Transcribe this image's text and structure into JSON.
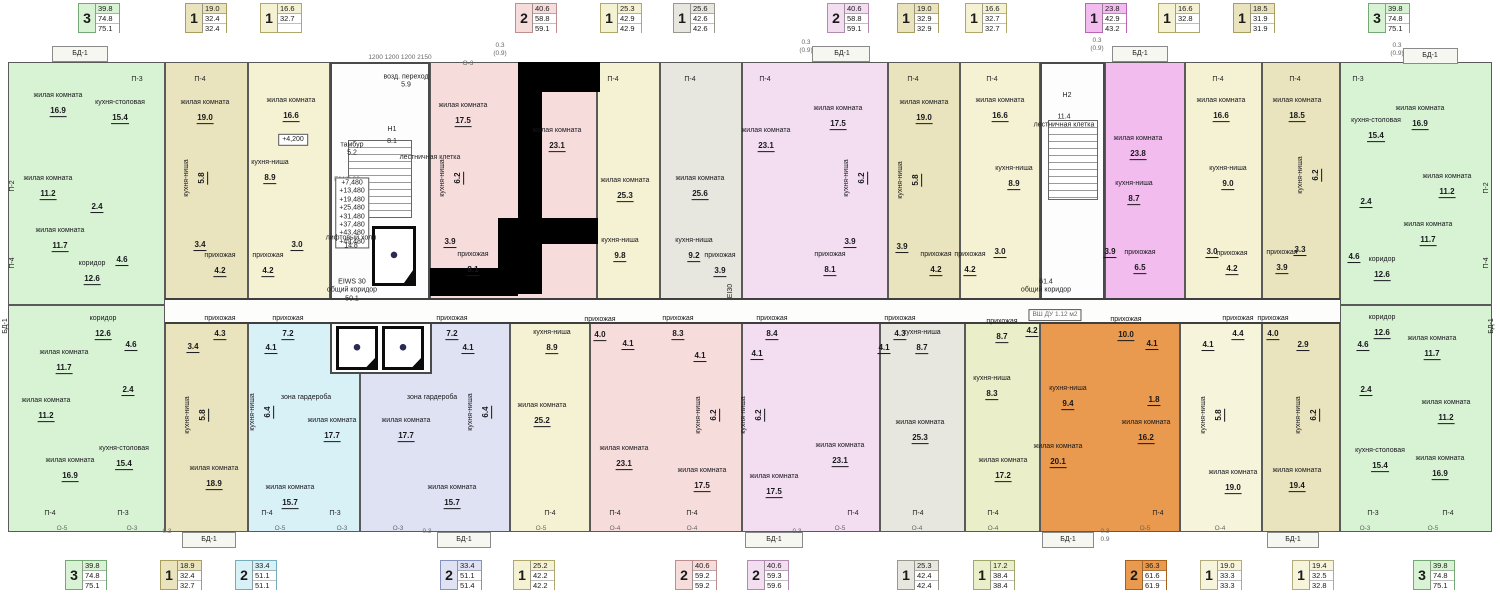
{
  "palette": {
    "green": "#d8f2d4",
    "olive": "#e9e4bd",
    "yellow": "#f5f1d3",
    "pink": "#f7dcdc",
    "gray": "#e7e7e0",
    "violet": "#f3ddf1",
    "magenta": "#f2bcee",
    "cyan": "#d8f1f7",
    "lavender": "#dfe2f3",
    "orange": "#e99a4e",
    "cream": "#f7f4dc",
    "yellowgreen": "#ebefc9",
    "wall": "#3f3f3f"
  },
  "badge_borders": {
    "green": "#74a874",
    "olive": "#a89e5e",
    "yellow": "#b0a86a",
    "pink": "#bf8f8f",
    "gray": "#98988e",
    "violet": "#b28cb0",
    "magenta": "#bf63b7",
    "cyan": "#74aebc",
    "lavender": "#8791bf",
    "orange": "#a95f18",
    "cream": "#b3ab7c",
    "yellowgreen": "#9fa868"
  },
  "top_badges": [
    {
      "c": "green",
      "rooms": "3",
      "vals": [
        "39.8",
        "74.8",
        "75.1"
      ]
    },
    {
      "c": "olive",
      "rooms": "1",
      "vals": [
        "19.0",
        "32.4",
        "32.4"
      ]
    },
    {
      "c": "yellow",
      "rooms": "1",
      "vals": [
        "16.6",
        "32.7",
        ""
      ]
    },
    {
      "c": "pink",
      "rooms": "2",
      "vals": [
        "40.6",
        "58.8",
        "59.1"
      ]
    },
    {
      "c": "yellow",
      "rooms": "1",
      "vals": [
        "25.3",
        "42.9",
        "42.9"
      ]
    },
    {
      "c": "gray",
      "rooms": "1",
      "vals": [
        "25.6",
        "42.6",
        "42.6"
      ]
    },
    {
      "c": "violet",
      "rooms": "2",
      "vals": [
        "40.6",
        "58.8",
        "59.1"
      ]
    },
    {
      "c": "olive",
      "rooms": "1",
      "vals": [
        "19.0",
        "32.9",
        "32.9"
      ]
    },
    {
      "c": "yellow",
      "rooms": "1",
      "vals": [
        "16.6",
        "32.7",
        "32.7"
      ]
    },
    {
      "c": "magenta",
      "rooms": "1",
      "vals": [
        "23.8",
        "42.9",
        "43.2"
      ]
    },
    {
      "c": "yellow",
      "rooms": "1",
      "vals": [
        "16.6",
        "32.8",
        ""
      ]
    },
    {
      "c": "olive",
      "rooms": "1",
      "vals": [
        "18.5",
        "31.9",
        "31.9"
      ]
    },
    {
      "c": "green",
      "rooms": "3",
      "vals": [
        "39.8",
        "74.8",
        "75.1"
      ]
    }
  ],
  "bottom_badges": [
    {
      "c": "green",
      "rooms": "3",
      "vals": [
        "39.8",
        "74.8",
        "75.1"
      ]
    },
    {
      "c": "olive",
      "rooms": "1",
      "vals": [
        "18.9",
        "32.4",
        "32.7"
      ]
    },
    {
      "c": "cyan",
      "rooms": "2",
      "vals": [
        "33.4",
        "51.1",
        "51.1"
      ]
    },
    {
      "c": "lavender",
      "rooms": "2",
      "vals": [
        "33.4",
        "51.1",
        "51.4"
      ]
    },
    {
      "c": "yellow",
      "rooms": "1",
      "vals": [
        "25.2",
        "42.2",
        "42.2"
      ]
    },
    {
      "c": "pink",
      "rooms": "2",
      "vals": [
        "40.6",
        "59.2",
        "59.2"
      ]
    },
    {
      "c": "violet",
      "rooms": "2",
      "vals": [
        "40.6",
        "59.3",
        "59.6"
      ]
    },
    {
      "c": "gray",
      "rooms": "1",
      "vals": [
        "25.3",
        "42.4",
        "42.4"
      ]
    },
    {
      "c": "yellowgreen",
      "rooms": "1",
      "vals": [
        "17.2",
        "38.4",
        "38.4"
      ]
    },
    {
      "c": "orange",
      "rooms": "2",
      "vals": [
        "36.3",
        "61.6",
        "61.9"
      ]
    },
    {
      "c": "cream",
      "rooms": "1",
      "vals": [
        "19.0",
        "33.3",
        "33.3"
      ]
    },
    {
      "c": "cream",
      "rooms": "1",
      "vals": [
        "19.4",
        "32.5",
        "32.8"
      ]
    },
    {
      "c": "green",
      "rooms": "3",
      "vals": [
        "39.8",
        "74.8",
        "75.1"
      ]
    }
  ],
  "plan": {
    "apartments": [
      {
        "id": "a1",
        "color": "green",
        "rooms": [
          {
            "n": "жилая комната",
            "a": "16.9"
          },
          {
            "n": "кухня-столовая",
            "a": "15.4"
          },
          {
            "n": "жилая комната",
            "a": "11.2"
          },
          {
            "a": "2.4"
          },
          {
            "n": "жилая комната",
            "a": "11.7"
          },
          {
            "a": "4.6"
          },
          {
            "n": "коридор",
            "a": "12.6"
          }
        ]
      },
      {
        "id": "a2",
        "color": "olive",
        "rooms": [
          {
            "n": "жилая комната",
            "a": "19.0"
          },
          {
            "n": "кухня-ниша",
            "a": "5.8",
            "v": 1
          },
          {
            "a": "3.4"
          },
          {
            "n": "прихожая",
            "a": "4.2"
          }
        ]
      },
      {
        "id": "a3",
        "color": "yellow",
        "rooms": [
          {
            "n": "жилая комната",
            "a": "16.6"
          },
          {
            "n": "кухня-ниша",
            "a": "8.9"
          },
          {
            "a": "3.0"
          },
          {
            "n": "прихожая",
            "a": "4.2"
          }
        ]
      },
      {
        "id": "a4",
        "color": "pink",
        "rooms": [
          {
            "n": "жилая комната",
            "a": "17.5"
          },
          {
            "n": "жилая комната",
            "a": "23.1"
          },
          {
            "n": "кухня-ниша",
            "a": "6.2",
            "v": 1
          },
          {
            "a": "3.9"
          },
          {
            "n": "прихожая",
            "a": "8.1"
          }
        ]
      },
      {
        "id": "a5",
        "color": "yellow",
        "rooms": [
          {
            "n": "жилая комната",
            "a": "25.3"
          },
          {
            "n": "кухня-ниша",
            "a": "9.8"
          }
        ]
      },
      {
        "id": "a6",
        "color": "gray",
        "rooms": [
          {
            "n": "жилая комната",
            "a": "25.6"
          },
          {
            "n": "кухня-ниша",
            "a": "9.2"
          },
          {
            "n": "прихожая",
            "a": "3.9"
          }
        ]
      },
      {
        "id": "a7",
        "color": "violet",
        "rooms": [
          {
            "n": "жилая комната",
            "a": "23.1"
          },
          {
            "n": "жилая комната",
            "a": "17.5"
          },
          {
            "n": "кухня-ниша",
            "a": "6.2",
            "v": 1
          },
          {
            "a": "3.9"
          },
          {
            "n": "прихожая",
            "a": "8.1"
          }
        ]
      },
      {
        "id": "a8",
        "color": "olive",
        "rooms": [
          {
            "n": "жилая комната",
            "a": "19.0"
          },
          {
            "n": "кухня-ниша",
            "a": "5.8",
            "v": 1
          },
          {
            "a": "3.9"
          },
          {
            "n": "прихожая",
            "a": "4.2"
          }
        ]
      },
      {
        "id": "a9",
        "color": "yellow",
        "rooms": [
          {
            "n": "жилая комната",
            "a": "16.6"
          },
          {
            "n": "кухня-ниша",
            "a": "8.9"
          },
          {
            "a": "3.0"
          },
          {
            "n": "прихожая",
            "a": "4.2"
          }
        ]
      },
      {
        "id": "a10",
        "color": "magenta",
        "rooms": [
          {
            "n": "жилая комната",
            "a": "23.8"
          },
          {
            "n": "кухня-ниша",
            "a": "8.7"
          },
          {
            "a": "3.9"
          },
          {
            "n": "прихожая",
            "a": "6.5"
          }
        ]
      },
      {
        "id": "a11",
        "color": "yellow",
        "rooms": [
          {
            "n": "жилая комната",
            "a": "16.6"
          },
          {
            "n": "кухня-ниша",
            "a": "9.0"
          },
          {
            "a": "3.0"
          },
          {
            "n": "прихожая",
            "a": "4.2"
          }
        ]
      },
      {
        "id": "a12",
        "color": "olive",
        "rooms": [
          {
            "n": "жилая комната",
            "a": "18.5"
          },
          {
            "n": "кухня-ниша",
            "a": "6.2",
            "v": 1
          },
          {
            "a": "3.3"
          },
          {
            "n": "прихожая",
            "a": "3.9"
          }
        ]
      },
      {
        "id": "a13",
        "color": "green",
        "rooms": [
          {
            "n": "кухня-столовая",
            "a": "15.4"
          },
          {
            "n": "жилая комната",
            "a": "16.9"
          },
          {
            "n": "жилая комната",
            "a": "11.2"
          },
          {
            "a": "2.4"
          },
          {
            "n": "жилая комната",
            "a": "11.7"
          },
          {
            "a": "4.6"
          },
          {
            "n": "коридор",
            "a": "12.6"
          }
        ]
      },
      {
        "id": "b1",
        "color": "green",
        "rooms": [
          {
            "n": "коридор",
            "a": "12.6"
          },
          {
            "a": "4.6"
          },
          {
            "n": "жилая комната",
            "a": "11.7"
          },
          {
            "a": "2.4"
          },
          {
            "n": "жилая комната",
            "a": "11.2"
          },
          {
            "n": "жилая комната",
            "a": "16.9"
          },
          {
            "n": "кухня-столовая",
            "a": "15.4"
          }
        ]
      },
      {
        "id": "b2",
        "color": "olive",
        "rooms": [
          {
            "n": "прихожая",
            "a": "4.3"
          },
          {
            "a": "3.4"
          },
          {
            "n": "кухня-ниша",
            "a": "5.8",
            "v": 1
          },
          {
            "n": "жилая комната",
            "a": "18.9"
          }
        ]
      },
      {
        "id": "b3",
        "color": "cyan",
        "rooms": [
          {
            "n": "прихожая",
            "a": "7.2"
          },
          {
            "a": "4.1"
          },
          {
            "n": "кухня-ниша",
            "a": "6.4",
            "v": 1
          },
          {
            "n": "зона гардероба"
          },
          {
            "n": "жилая комната",
            "a": "17.7"
          },
          {
            "n": "жилая комната",
            "a": "15.7"
          }
        ]
      },
      {
        "id": "b4",
        "color": "lavender",
        "rooms": [
          {
            "n": "прихожая",
            "a": "7.2"
          },
          {
            "a": "4.1"
          },
          {
            "n": "кухня-ниша",
            "a": "6.4",
            "v": 1
          },
          {
            "n": "зона гардероба"
          },
          {
            "n": "жилая комната",
            "a": "17.7"
          },
          {
            "n": "жилая комната",
            "a": "15.7"
          }
        ]
      },
      {
        "id": "b5",
        "color": "yellow",
        "rooms": [
          {
            "n": "кухня-ниша",
            "a": "8.9"
          },
          {
            "n": "прихожая",
            "a": "4.0"
          },
          {
            "a": "4.1"
          },
          {
            "n": "жилая комната",
            "a": "25.2"
          }
        ]
      },
      {
        "id": "b6",
        "color": "pink",
        "rooms": [
          {
            "n": "прихожая",
            "a": "8.3"
          },
          {
            "a": "4.1"
          },
          {
            "n": "кухня-ниша",
            "a": "6.2",
            "v": 1
          },
          {
            "n": "жилая комната",
            "a": "23.1"
          },
          {
            "n": "жилая комната",
            "a": "17.5"
          }
        ]
      },
      {
        "id": "b7",
        "color": "violet",
        "rooms": [
          {
            "n": "прихожая",
            "a": "8.4"
          },
          {
            "a": "4.1"
          },
          {
            "n": "кухня-ниша",
            "a": "6.2",
            "v": 1
          },
          {
            "n": "жилая комната",
            "a": "23.1"
          },
          {
            "n": "жилая комната",
            "a": "17.5"
          }
        ]
      },
      {
        "id": "b8",
        "color": "gray",
        "rooms": [
          {
            "n": "прихожая",
            "a": "4.3"
          },
          {
            "a": "4.1"
          },
          {
            "n": "кухня-ниша",
            "a": "8.7"
          },
          {
            "n": "жилая комната",
            "a": "25.3"
          }
        ]
      },
      {
        "id": "b9",
        "color": "yellowgreen",
        "rooms": [
          {
            "n": "прихожая",
            "a": "8.7"
          },
          {
            "a": "4.2"
          },
          {
            "n": "кухня-ниша",
            "a": "8.3"
          },
          {
            "n": "жилая комната",
            "a": "17.2"
          }
        ]
      },
      {
        "id": "b10",
        "color": "orange",
        "rooms": [
          {
            "n": "прихожая",
            "a": "10.0"
          },
          {
            "a": "4.1"
          },
          {
            "n": "кухня-ниша",
            "a": "9.4"
          },
          {
            "a": "1.8"
          },
          {
            "n": "жилая комната",
            "a": "20.1"
          },
          {
            "n": "жилая комната",
            "a": "16.2"
          }
        ]
      },
      {
        "id": "b11",
        "color": "cream",
        "rooms": [
          {
            "n": "прихожая",
            "a": "4.4"
          },
          {
            "a": "4.1"
          },
          {
            "n": "кухня-ниша",
            "a": "5.8",
            "v": 1
          },
          {
            "n": "жилая комната",
            "a": "19.0"
          }
        ]
      },
      {
        "id": "b12",
        "color": "olive",
        "rooms": [
          {
            "n": "прихожая",
            "a": "4.0"
          },
          {
            "a": "2.9"
          },
          {
            "n": "кухня-ниша",
            "a": "6.2",
            "v": 1
          },
          {
            "n": "жилая комната",
            "a": "19.4"
          }
        ]
      },
      {
        "id": "b13",
        "color": "green",
        "rooms": [
          {
            "n": "коридор",
            "a": "12.6"
          },
          {
            "a": "4.6"
          },
          {
            "n": "жилая комната",
            "a": "11.7"
          },
          {
            "a": "2.4"
          },
          {
            "n": "жилая комната",
            "a": "11.2"
          },
          {
            "n": "кухня-столовая",
            "a": "15.4"
          },
          {
            "n": "жилая комната",
            "a": "16.9"
          }
        ]
      }
    ],
    "labels": [
      "БД-1",
      "П-3",
      "П-4",
      "возд. переход\n5.9",
      "1200   1200   1200   2150",
      "О-3",
      "0.3\n(0.9)",
      "тамбур\n5.2",
      "H1",
      "8.1",
      "лестничная клетка",
      "EIWS 30",
      "+7,480\n+13,480\n+19,480\n+25,480\n+31,480\n+37,480\n+43,480\n+49,480",
      "лифтовый холл\n14.8",
      "EIWS 30\nобщий коридор\n50.1",
      "+4,200",
      "П-4",
      "П-4",
      "EI30",
      "0.3\n(0.9)",
      "БД-1",
      "П-4",
      "П-4",
      "П-4",
      "H2",
      "11.4\nлестничная клетка",
      "61.4\nобщий коридор",
      "ВШ ДУ  1.12 м2",
      "0.3\n(0.9)",
      "БД-1",
      "П-4",
      "П-4",
      "П-3",
      "0.3\n(0.9)",
      "БД-1",
      "П-2",
      "П-4",
      "БД-1",
      "П-2",
      "П-4",
      "БД-1",
      "П-4",
      "П-3",
      "О-5",
      "О-3",
      "0.3",
      "БД-1",
      "П-4",
      "П-3",
      "О-5",
      "О-3",
      "О-3",
      "0.3",
      "БД-1",
      "П-4",
      "О-5",
      "П-4",
      "О-4",
      "П-4",
      "О-4",
      "БД-1",
      "0.3",
      "П-4",
      "О-5",
      "П-4",
      "О-4",
      "П-4",
      "О-4",
      "БД-1",
      "0.3\n0.9",
      "П-4",
      "О-5",
      "О-4",
      "БД-1",
      "П-3",
      "О-3",
      "П-4",
      "О-5"
    ]
  }
}
